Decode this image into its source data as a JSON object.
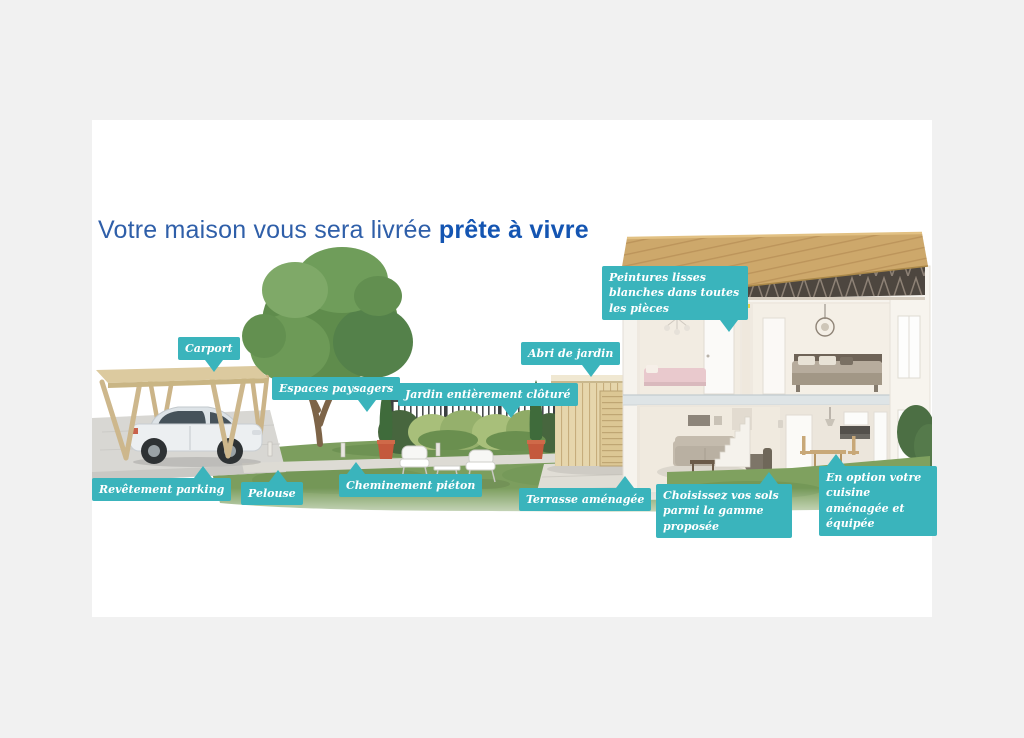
{
  "page": {
    "background_color": "#f1f1f1",
    "canvas_background_color": "#ffffff",
    "accent_color": "#3ab4bc",
    "title_color_regular": "#2f5fa9",
    "title_color_bold": "#1455b2"
  },
  "title": {
    "regular": "Votre maison vous sera livrée ",
    "bold": "prête à vivre"
  },
  "labels": [
    {
      "id": "carport",
      "text": "Carport"
    },
    {
      "id": "espaces-paysagers",
      "text": "Espaces paysagers"
    },
    {
      "id": "revetement-parking",
      "text": "Revêtement parking"
    },
    {
      "id": "pelouse",
      "text": "Pelouse"
    },
    {
      "id": "cheminement-pieton",
      "text": "Cheminement piéton"
    },
    {
      "id": "jardin-cloture",
      "text": "Jardin entièrement clôturé"
    },
    {
      "id": "abri-de-jardin",
      "text": "Abri de jardin"
    },
    {
      "id": "terrasse-amenagee",
      "text": "Terrasse aménagée"
    },
    {
      "id": "peintures",
      "text": "Peintures lisses blanches dans toutes les pièces"
    },
    {
      "id": "sols",
      "text": "Choisissez vos sols parmi la gamme proposée"
    },
    {
      "id": "cuisine",
      "text": "En option votre cuisine aménagée et équipée"
    }
  ],
  "scene": {
    "description": "Cutaway illustration of a new-build house with garden",
    "elements": [
      "carport",
      "car",
      "tree",
      "lawn",
      "fence",
      "hedge",
      "garden-path",
      "bollard-lights",
      "garden-furniture",
      "cypress-trees",
      "flower-pots",
      "garden-shed",
      "terrace",
      "house-cutaway",
      "roof",
      "roof-trusses",
      "kids-bedroom",
      "master-bedroom",
      "living-room",
      "staircase",
      "dining-area",
      "kitchen"
    ]
  }
}
